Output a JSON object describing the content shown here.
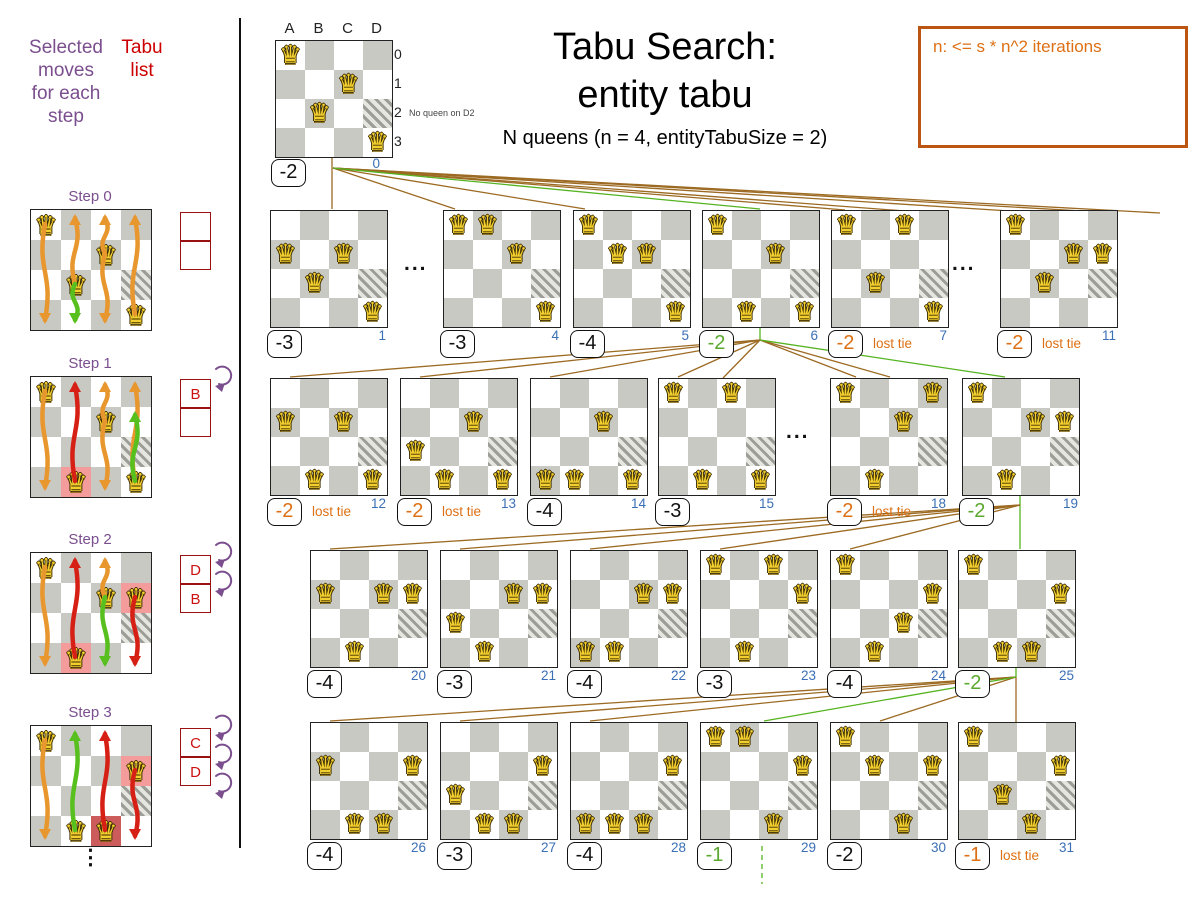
{
  "colors": {
    "purple": "#7b4e8e",
    "red": "#cc0000",
    "orange": "#dd7014",
    "green": "#5aa82c",
    "blue": "#3a6fb5",
    "brown": "#9c6a22",
    "line_green": "#55b320",
    "gold": "#f2ce2e",
    "board_gray": "#c9c9c3",
    "highlight_pink": "#f49c9c",
    "highlight_dark_red": "#cc5c5c"
  },
  "header": {
    "title_line1": "Tabu Search:",
    "title_line2": "entity tabu",
    "subtitle": "N queens (n = 4, entityTabuSize = 2)",
    "note": "n: <= s * n^2 iterations"
  },
  "left_panel": {
    "selected_moves_label": "Selected\nmoves\nfor each\nstep",
    "tabu_list_label": "Tabu\nlist",
    "more_symbol": "⋮",
    "steps": [
      {
        "label": "Step 0",
        "queens": [
          "A0",
          "C1",
          "B2",
          "D3"
        ],
        "highlights": {},
        "tabu": [
          "",
          ""
        ],
        "curls": 0,
        "arrows": [
          {
            "c": 0,
            "f": 0,
            "t": 3,
            "col": "orange"
          },
          {
            "c": 1,
            "f": 2,
            "t": 0,
            "col": "orange"
          },
          {
            "c": 1,
            "f": 2,
            "t": 3,
            "col": "green"
          },
          {
            "c": 2,
            "f": 1,
            "t": 0,
            "col": "orange"
          },
          {
            "c": 2,
            "f": 1,
            "t": 3,
            "col": "orange"
          },
          {
            "c": 3,
            "f": 3,
            "t": 0,
            "col": "orange"
          }
        ]
      },
      {
        "label": "Step 1",
        "queens": [
          "A0",
          "C1",
          "B3",
          "D3"
        ],
        "highlights": {
          "B3": "pink"
        },
        "tabu": [
          "B",
          ""
        ],
        "curls": 1,
        "arrows": [
          {
            "c": 0,
            "f": 0,
            "t": 3,
            "col": "orange"
          },
          {
            "c": 1,
            "f": 3,
            "t": 0,
            "col": "red"
          },
          {
            "c": 2,
            "f": 1,
            "t": 0,
            "col": "orange"
          },
          {
            "c": 2,
            "f": 1,
            "t": 3,
            "col": "orange"
          },
          {
            "c": 3,
            "f": 3,
            "t": 0,
            "col": "orange"
          },
          {
            "c": 3,
            "f": 3,
            "t": 1,
            "col": "green"
          }
        ]
      },
      {
        "label": "Step 2",
        "queens": [
          "A0",
          "C1",
          "D1",
          "B3"
        ],
        "highlights": {
          "D1": "pink",
          "B3": "pink"
        },
        "tabu": [
          "D",
          "B"
        ],
        "curls": 2,
        "arrows": [
          {
            "c": 0,
            "f": 0,
            "t": 3,
            "col": "orange"
          },
          {
            "c": 1,
            "f": 3,
            "t": 0,
            "col": "red"
          },
          {
            "c": 2,
            "f": 1,
            "t": 0,
            "col": "orange"
          },
          {
            "c": 2,
            "f": 1,
            "t": 3,
            "col": "green"
          },
          {
            "c": 3,
            "f": 1,
            "t": 3,
            "col": "red"
          }
        ]
      },
      {
        "label": "Step 3",
        "queens": [
          "A0",
          "D1",
          "B3",
          "C3"
        ],
        "highlights": {
          "D1": "pink",
          "C3": "dark"
        },
        "tabu": [
          "C",
          "D"
        ],
        "curls": 3,
        "arrows": [
          {
            "c": 0,
            "f": 0,
            "t": 3,
            "col": "orange"
          },
          {
            "c": 1,
            "f": 3,
            "t": 0,
            "col": "green"
          },
          {
            "c": 2,
            "f": 3,
            "t": 0,
            "col": "red"
          },
          {
            "c": 3,
            "f": 1,
            "t": 3,
            "col": "red"
          }
        ]
      }
    ]
  },
  "root_board": {
    "columns": [
      "A",
      "B",
      "C",
      "D"
    ],
    "rows": [
      "0",
      "1",
      "2",
      "3"
    ],
    "queens": [
      "A0",
      "C1",
      "B2",
      "D3"
    ],
    "hatch_cell": "D2",
    "hatch_note": "No queen on D2",
    "score": "-2",
    "index": "0"
  },
  "tree": {
    "dots_symbol": "...",
    "lost_tie_text": "lost tie",
    "rows": [
      {
        "items": [
          {
            "type": "board",
            "index": "1",
            "score": "-3",
            "variant": "normal",
            "queens": [
              "A1",
              "C1",
              "B2",
              "D3"
            ]
          },
          {
            "type": "dots"
          },
          {
            "type": "board",
            "index": "4",
            "score": "-3",
            "variant": "normal",
            "queens": [
              "A0",
              "B0",
              "C1",
              "D3"
            ]
          },
          {
            "type": "board",
            "index": "5",
            "score": "-4",
            "variant": "normal",
            "queens": [
              "A0",
              "B1",
              "C1",
              "D3"
            ]
          },
          {
            "type": "board",
            "index": "6",
            "score": "-2",
            "variant": "selected",
            "queens": [
              "A0",
              "C1",
              "B3",
              "D3"
            ]
          },
          {
            "type": "board",
            "index": "7",
            "score": "-2",
            "variant": "lost",
            "label": "lost tie",
            "queens": [
              "A0",
              "C0",
              "B2",
              "D3"
            ]
          },
          {
            "type": "dots"
          },
          {
            "type": "board",
            "index": "11",
            "score": "-2",
            "variant": "lost",
            "label": "lost tie",
            "queens": [
              "A0",
              "C1",
              "D1",
              "B2"
            ]
          }
        ]
      },
      {
        "items": [
          {
            "type": "board",
            "index": "12",
            "score": "-2",
            "variant": "lost",
            "label": "lost tie",
            "queens": [
              "A1",
              "C1",
              "B3",
              "D3"
            ]
          },
          {
            "type": "board",
            "index": "13",
            "score": "-2",
            "variant": "lost",
            "label": "lost tie",
            "queens": [
              "A2",
              "C1",
              "B3",
              "D3"
            ]
          },
          {
            "type": "board",
            "index": "14",
            "score": "-4",
            "variant": "normal",
            "queens": [
              "C1",
              "A3",
              "B3",
              "D3"
            ]
          },
          {
            "type": "board",
            "index": "15",
            "score": "-3",
            "variant": "normal",
            "queens": [
              "A0",
              "C0",
              "B3",
              "D3"
            ]
          },
          {
            "type": "dots"
          },
          {
            "type": "board",
            "index": "18",
            "score": "-2",
            "variant": "lost",
            "label": "lost tie",
            "queens": [
              "A0",
              "D0",
              "C1",
              "B3"
            ]
          },
          {
            "type": "board",
            "index": "19",
            "score": "-2",
            "variant": "selected",
            "queens": [
              "A0",
              "C1",
              "D1",
              "B3"
            ]
          }
        ]
      },
      {
        "items": [
          {
            "type": "board",
            "index": "20",
            "score": "-4",
            "variant": "normal",
            "queens": [
              "A1",
              "C1",
              "D1",
              "B3"
            ]
          },
          {
            "type": "board",
            "index": "21",
            "score": "-3",
            "variant": "normal",
            "queens": [
              "C1",
              "D1",
              "A2",
              "B3"
            ]
          },
          {
            "type": "board",
            "index": "22",
            "score": "-4",
            "variant": "normal",
            "queens": [
              "C1",
              "D1",
              "A3",
              "B3"
            ]
          },
          {
            "type": "board",
            "index": "23",
            "score": "-3",
            "variant": "normal",
            "queens": [
              "A0",
              "C0",
              "D1",
              "B3"
            ]
          },
          {
            "type": "board",
            "index": "24",
            "score": "-4",
            "variant": "normal",
            "queens": [
              "A0",
              "D1",
              "C2",
              "B3"
            ]
          },
          {
            "type": "board",
            "index": "25",
            "score": "-2",
            "variant": "selected",
            "queens": [
              "A0",
              "D1",
              "B3",
              "C3"
            ]
          }
        ]
      },
      {
        "items": [
          {
            "type": "board",
            "index": "26",
            "score": "-4",
            "variant": "normal",
            "queens": [
              "A1",
              "D1",
              "B3",
              "C3"
            ]
          },
          {
            "type": "board",
            "index": "27",
            "score": "-3",
            "variant": "normal",
            "queens": [
              "D1",
              "A2",
              "B3",
              "C3"
            ]
          },
          {
            "type": "board",
            "index": "28",
            "score": "-4",
            "variant": "normal",
            "queens": [
              "D1",
              "A3",
              "B3",
              "C3"
            ]
          },
          {
            "type": "board",
            "index": "29",
            "score": "-1",
            "variant": "selected",
            "queens": [
              "A0",
              "B0",
              "D1",
              "C3"
            ]
          },
          {
            "type": "board",
            "index": "30",
            "score": "-2",
            "variant": "normal",
            "queens": [
              "A0",
              "B1",
              "D1",
              "C3"
            ]
          },
          {
            "type": "board",
            "index": "31",
            "score": "-1",
            "variant": "lost",
            "label": "lost tie",
            "queens": [
              "A0",
              "D1",
              "B2",
              "C3"
            ]
          }
        ]
      }
    ]
  }
}
